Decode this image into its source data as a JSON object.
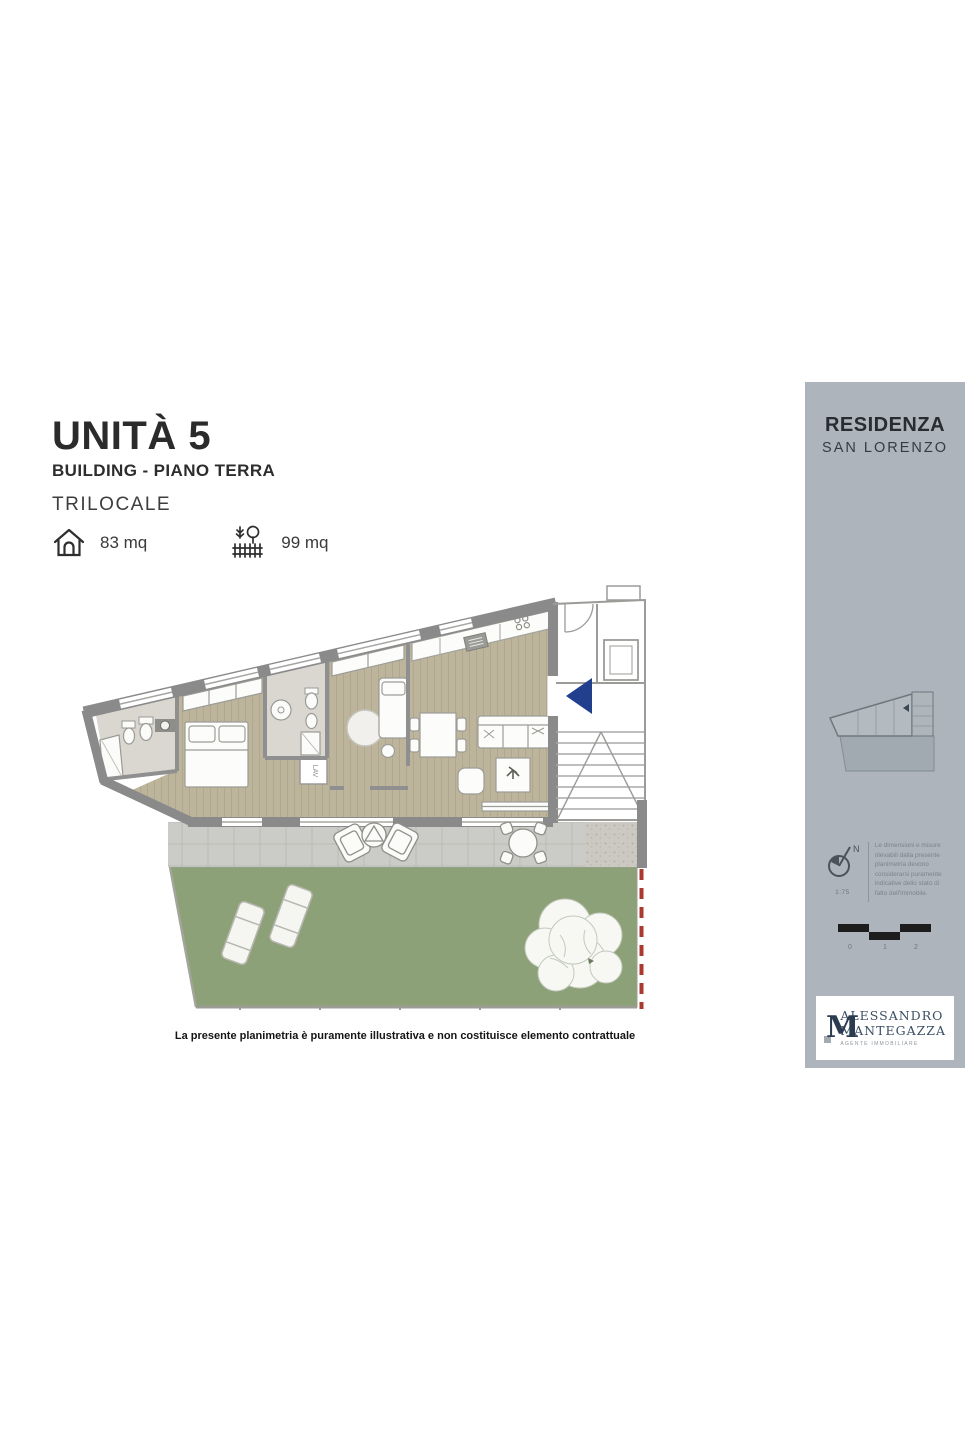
{
  "header": {
    "title": "UNITÀ 5",
    "subtitle": "BUILDING - PIANO TERRA",
    "dwelling_type": "TRILOCALE",
    "interior_area": "83 mq",
    "exterior_area": "99 mq"
  },
  "plan": {
    "laundry_label": "LAV",
    "disclaimer": "La presente planimetria è puramente illustrativa e non costituisce elemento contrattuale"
  },
  "sidebar": {
    "residence_line1": "RESIDENZA",
    "residence_line2": "SAN LORENZO",
    "north_label": "N",
    "scale_ratio": "1:75",
    "measurement_note": "Le dimensioni e misure rilevabili dalla presente planimetria devono considerarsi puramente indicative dello stato di fatto dell'immobile.",
    "scalebar_labels": [
      "0",
      "1",
      "2"
    ],
    "logo": {
      "monogram": "M",
      "name_line1": "ALESSANDRO",
      "name_line2": "MANTEGAZZA",
      "tagline": "AGENTE IMMOBILIARE"
    }
  },
  "colors": {
    "sidebar_bg": "#adb4bb",
    "wall_gray": "#8a8a8a",
    "wood_floor": "#bdb49c",
    "bath_floor": "#dad7d1",
    "terrace_paver": "#cbccc7",
    "garden_green": "#8da178",
    "entry_arrow_blue": "#223f8e",
    "boundary_red": "#ab3a2c"
  }
}
